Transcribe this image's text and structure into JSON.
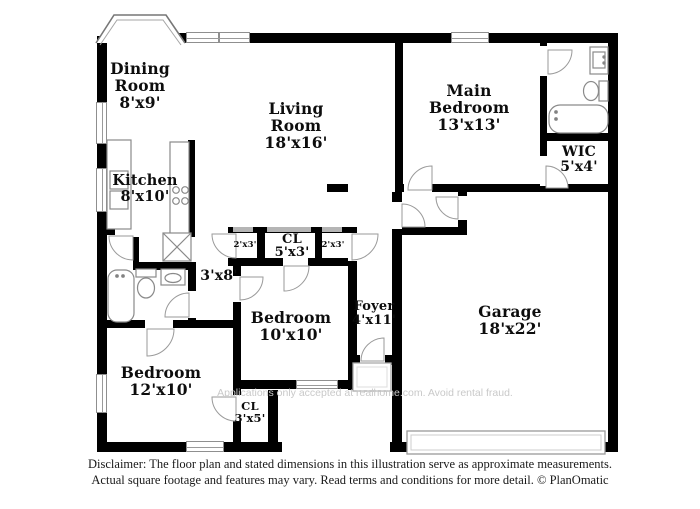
{
  "floorplan": {
    "rooms": [
      {
        "id": "dining-room",
        "name": "Dining Room",
        "dims": "8'x9'"
      },
      {
        "id": "living-room",
        "name": "Living Room",
        "dims": "18'x16'"
      },
      {
        "id": "main-bedroom",
        "name": "Main Bedroom",
        "dims": "13'x13'"
      },
      {
        "id": "wic",
        "name": "WIC",
        "dims": "5'x4'"
      },
      {
        "id": "kitchen",
        "name": "Kitchen",
        "dims": "8'x10'"
      },
      {
        "id": "hall",
        "name": "",
        "dims": "3'x8'"
      },
      {
        "id": "closet-left",
        "name": "",
        "dims": "2'x3'"
      },
      {
        "id": "closet-center",
        "name": "CL",
        "dims": "5'x3'"
      },
      {
        "id": "closet-right",
        "name": "",
        "dims": "2'x3'"
      },
      {
        "id": "bedroom-10x10",
        "name": "Bedroom",
        "dims": "10'x10'"
      },
      {
        "id": "foyer",
        "name": "Foyer",
        "dims": "4'x11'"
      },
      {
        "id": "garage",
        "name": "Garage",
        "dims": "18'x22'"
      },
      {
        "id": "bedroom-12x10",
        "name": "Bedroom",
        "dims": "12'x10'"
      },
      {
        "id": "closet-bottom",
        "name": "CL",
        "dims": "3'x5'"
      }
    ],
    "watermark": "Applications only accepted at realhome.com. Avoid rental fraud.",
    "colors": {
      "wall": "#000000",
      "fixture_outline": "#8a8a8a",
      "watermark_text": "#c9c9c9",
      "label_text": "#0d0d0d"
    }
  },
  "footer": {
    "disclaimer_line1": "Disclaimer: The floor plan and stated dimensions in this illustration serve as approximate measurements.",
    "disclaimer_line2": "Actual square footage and features may vary. Read terms and conditions for more detail. © PlanOmatic"
  }
}
